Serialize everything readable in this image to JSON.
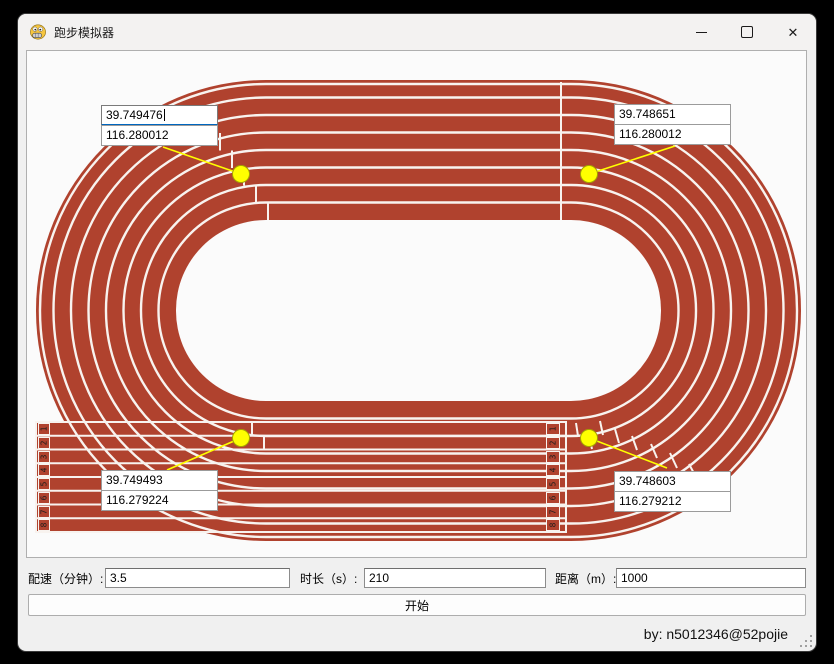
{
  "titlebar": {
    "title": "跑步模拟器",
    "close_glyph": "✕"
  },
  "canvas": {
    "markers": {
      "top_left": {
        "line1": "39.749476",
        "line2": "116.280012"
      },
      "top_right": {
        "line1": "39.748651",
        "line2": "116.280012"
      },
      "bottom_left": {
        "line1": "39.749493",
        "line2": "116.279224"
      },
      "bottom_right": {
        "line1": "39.748603",
        "line2": "116.279212"
      }
    },
    "lane_numbers": [
      "1",
      "2",
      "3",
      "4",
      "5",
      "6",
      "7",
      "8"
    ]
  },
  "controls": {
    "pace_label": "配速（分钟）:",
    "pace_value": "3.5",
    "duration_label": "时长（s）:",
    "duration_value": "210",
    "distance_label": "距离（m）:",
    "distance_value": "1000",
    "start_label": "开始"
  },
  "statusbar": {
    "credit": "by: n5012346@52pojie"
  },
  "colors": {
    "track_red": "#B0422E",
    "lane_line": "#F8F3EF",
    "marker_yellow": "#FFFF00",
    "focus_blue": "#0067C0"
  }
}
